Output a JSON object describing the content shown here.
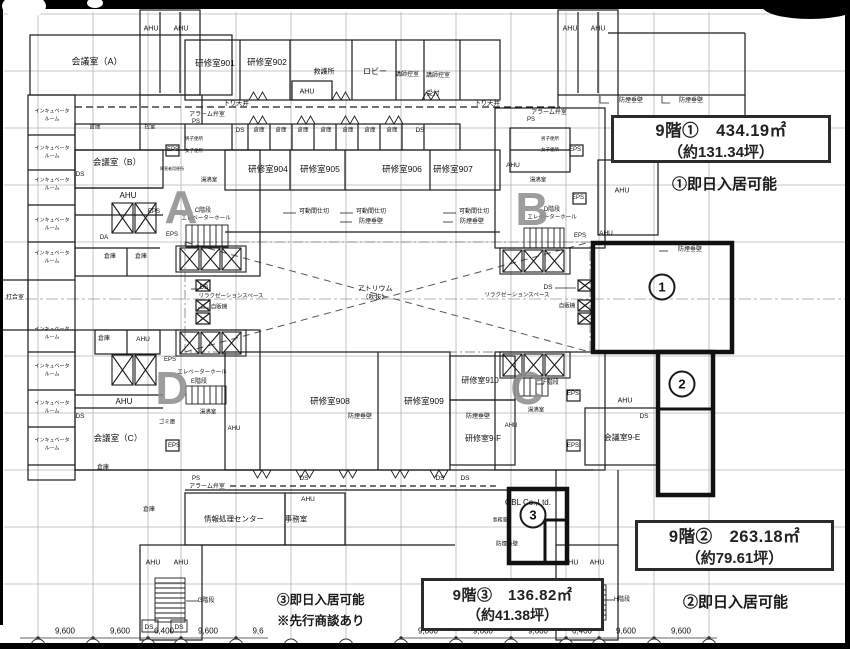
{
  "plan": {
    "boxes": {
      "area1": {
        "line1": "9階①　434.19㎡",
        "line2": "（約131.34坪）",
        "note": "①即日入居可能"
      },
      "area2": {
        "line1": "9階②　263.18㎡",
        "line2": "（約79.61坪）",
        "note": "②即日入居可能"
      },
      "area3": {
        "line1": "9階③　136.82㎡",
        "line2": "（約41.38坪）",
        "note_line1": "③即日入居可能",
        "note_line2": "※先行商談あり"
      }
    },
    "zone_letters": [
      {
        "t": "A",
        "x": 181,
        "y": 207
      },
      {
        "t": "B",
        "x": 532,
        "y": 209
      },
      {
        "t": "D",
        "x": 172,
        "y": 388
      },
      {
        "t": "C",
        "x": 527,
        "y": 388
      }
    ],
    "area_markers": [
      {
        "n": "1",
        "x": 662,
        "y": 287
      },
      {
        "n": "2",
        "x": 682,
        "y": 384
      },
      {
        "n": "3",
        "x": 533,
        "y": 515
      }
    ],
    "labels": [
      {
        "t": "AHU",
        "x": 151,
        "y": 29,
        "s": 7
      },
      {
        "t": "AHU",
        "x": 181,
        "y": 29,
        "s": 7
      },
      {
        "t": "AHU",
        "x": 570,
        "y": 29,
        "s": 7
      },
      {
        "t": "AHU",
        "x": 598,
        "y": 29,
        "s": 7
      },
      {
        "t": "会議室（A）",
        "x": 97,
        "y": 62,
        "s": 9
      },
      {
        "t": "研修室901",
        "x": 215,
        "y": 63,
        "s": 8.5
      },
      {
        "t": "研修室902",
        "x": 267,
        "y": 62,
        "s": 8.5
      },
      {
        "t": "救護所",
        "x": 324,
        "y": 72,
        "s": 7
      },
      {
        "t": "ロビー",
        "x": 375,
        "y": 72,
        "s": 8
      },
      {
        "t": "講師控室",
        "x": 407,
        "y": 75,
        "s": 6
      },
      {
        "t": "講師控室",
        "x": 438,
        "y": 76,
        "s": 6
      },
      {
        "t": "受付",
        "x": 433,
        "y": 94,
        "s": 6.5
      },
      {
        "t": "AHU",
        "x": 307,
        "y": 92,
        "s": 7
      },
      {
        "t": "下り天井",
        "x": 236,
        "y": 104,
        "s": 6.5
      },
      {
        "t": "下り天井",
        "x": 487,
        "y": 104,
        "s": 6.5
      },
      {
        "t": "DS",
        "x": 240,
        "y": 131,
        "s": 6.5
      },
      {
        "t": "倉庫",
        "x": 95,
        "y": 128,
        "s": 5.5
      },
      {
        "t": "控室",
        "x": 150,
        "y": 128,
        "s": 5.5
      },
      {
        "t": "倉庫",
        "x": 259,
        "y": 131,
        "s": 5.5
      },
      {
        "t": "倉庫",
        "x": 281,
        "y": 131,
        "s": 5.5
      },
      {
        "t": "倉庫",
        "x": 303,
        "y": 131,
        "s": 5.5
      },
      {
        "t": "倉庫",
        "x": 326,
        "y": 131,
        "s": 5.5
      },
      {
        "t": "倉庫",
        "x": 348,
        "y": 131,
        "s": 5.5
      },
      {
        "t": "倉庫",
        "x": 370,
        "y": 131,
        "s": 5.5
      },
      {
        "t": "倉庫",
        "x": 392,
        "y": 131,
        "s": 5.5
      },
      {
        "t": "DS",
        "x": 420,
        "y": 131,
        "s": 6.5
      },
      {
        "t": "アラーム弁室",
        "x": 207,
        "y": 115,
        "s": 6
      },
      {
        "t": "PS",
        "x": 196,
        "y": 122,
        "s": 6
      },
      {
        "t": "アラーム弁室",
        "x": 549,
        "y": 113,
        "s": 6
      },
      {
        "t": "PS",
        "x": 531,
        "y": 120,
        "s": 6
      },
      {
        "t": "インキュベータ",
        "x": 52,
        "y": 112,
        "s": 5
      },
      {
        "t": "ルーム",
        "x": 52,
        "y": 120,
        "s": 5
      },
      {
        "t": "インキュベータ",
        "x": 52,
        "y": 149,
        "s": 5
      },
      {
        "t": "ルーム",
        "x": 52,
        "y": 157,
        "s": 5
      },
      {
        "t": "インキュベータ",
        "x": 52,
        "y": 181,
        "s": 5
      },
      {
        "t": "ルーム",
        "x": 52,
        "y": 189,
        "s": 5
      },
      {
        "t": "インキュベータ",
        "x": 52,
        "y": 221,
        "s": 5
      },
      {
        "t": "ルーム",
        "x": 52,
        "y": 229,
        "s": 5
      },
      {
        "t": "インキュベータ",
        "x": 52,
        "y": 254,
        "s": 5
      },
      {
        "t": "ルーム",
        "x": 52,
        "y": 262,
        "s": 5
      },
      {
        "t": "インキュベータ",
        "x": 52,
        "y": 330,
        "s": 5
      },
      {
        "t": "ルーム",
        "x": 52,
        "y": 338,
        "s": 5
      },
      {
        "t": "インキュベータ",
        "x": 52,
        "y": 367,
        "s": 5
      },
      {
        "t": "ルーム",
        "x": 52,
        "y": 375,
        "s": 5
      },
      {
        "t": "インキュベータ",
        "x": 52,
        "y": 404,
        "s": 5
      },
      {
        "t": "ルーム",
        "x": 52,
        "y": 412,
        "s": 5
      },
      {
        "t": "インキュベータ",
        "x": 52,
        "y": 441,
        "s": 5
      },
      {
        "t": "ルーム",
        "x": 52,
        "y": 449,
        "s": 5
      },
      {
        "t": "打合室",
        "x": 15,
        "y": 298,
        "s": 6
      },
      {
        "t": "会議室（B）",
        "x": 117,
        "y": 162,
        "s": 8.5
      },
      {
        "t": "EPS",
        "x": 173,
        "y": 150,
        "s": 6
      },
      {
        "t": "DS",
        "x": 80,
        "y": 175,
        "s": 6.5
      },
      {
        "t": "AHU",
        "x": 128,
        "y": 196,
        "s": 8
      },
      {
        "t": "男子便所",
        "x": 194,
        "y": 139,
        "s": 4.5
      },
      {
        "t": "女子便所",
        "x": 194,
        "y": 151,
        "s": 4.5
      },
      {
        "t": "障害者用便所",
        "x": 172,
        "y": 169,
        "s": 4
      },
      {
        "t": "湯沸室",
        "x": 209,
        "y": 181,
        "s": 5.5
      },
      {
        "t": "C階段",
        "x": 203,
        "y": 211,
        "s": 6
      },
      {
        "t": "エレベーターホール",
        "x": 206,
        "y": 219,
        "s": 5.5
      },
      {
        "t": "EPS",
        "x": 154,
        "y": 212,
        "s": 6
      },
      {
        "t": "EPS",
        "x": 172,
        "y": 235,
        "s": 6
      },
      {
        "t": "DA",
        "x": 104,
        "y": 238,
        "s": 6
      },
      {
        "t": "倉庫",
        "x": 110,
        "y": 257,
        "s": 6
      },
      {
        "t": "倉庫",
        "x": 141,
        "y": 257,
        "s": 6
      },
      {
        "t": "研修室904",
        "x": 268,
        "y": 169,
        "s": 8.5
      },
      {
        "t": "研修室905",
        "x": 320,
        "y": 169,
        "s": 8.5
      },
      {
        "t": "研修室906",
        "x": 402,
        "y": 169,
        "s": 8.5
      },
      {
        "t": "研修室907",
        "x": 453,
        "y": 169,
        "s": 8.5
      },
      {
        "t": "可動間仕切",
        "x": 314,
        "y": 212,
        "s": 6
      },
      {
        "t": "可動間仕切",
        "x": 371,
        "y": 212,
        "s": 6
      },
      {
        "t": "防煙垂壁",
        "x": 371,
        "y": 222,
        "s": 6
      },
      {
        "t": "可動間仕切",
        "x": 474,
        "y": 212,
        "s": 6
      },
      {
        "t": "防煙垂壁",
        "x": 472,
        "y": 222,
        "s": 6
      },
      {
        "t": "AHU",
        "x": 513,
        "y": 166,
        "s": 6.5
      },
      {
        "t": "男子便所",
        "x": 550,
        "y": 139,
        "s": 4.5
      },
      {
        "t": "女子便所",
        "x": 550,
        "y": 150,
        "s": 4.5
      },
      {
        "t": "湯沸室",
        "x": 538,
        "y": 181,
        "s": 5.5
      },
      {
        "t": "EPS",
        "x": 575,
        "y": 150,
        "s": 6
      },
      {
        "t": "EPS",
        "x": 578,
        "y": 198,
        "s": 6
      },
      {
        "t": "EPS",
        "x": 580,
        "y": 236,
        "s": 6
      },
      {
        "t": "D階段",
        "x": 552,
        "y": 210,
        "s": 6
      },
      {
        "t": "エレベーターホール",
        "x": 552,
        "y": 218,
        "s": 5.5
      },
      {
        "t": "防煙垂壁",
        "x": 631,
        "y": 101,
        "s": 6
      },
      {
        "t": "防煙垂壁",
        "x": 691,
        "y": 101,
        "s": 6
      },
      {
        "t": "AHU",
        "x": 622,
        "y": 191,
        "s": 7
      },
      {
        "t": "防煙垂壁",
        "x": 690,
        "y": 250,
        "s": 6
      },
      {
        "t": "AHU",
        "x": 606,
        "y": 234,
        "s": 6.5
      },
      {
        "t": "アトリウム",
        "x": 375,
        "y": 289,
        "s": 7
      },
      {
        "t": "（吹抜）",
        "x": 375,
        "y": 298,
        "s": 6.5
      },
      {
        "t": "DS",
        "x": 204,
        "y": 288,
        "s": 6.5
      },
      {
        "t": "リラクゼーションスペース",
        "x": 231,
        "y": 297,
        "s": 5.5
      },
      {
        "t": "自販機",
        "x": 219,
        "y": 308,
        "s": 5.5
      },
      {
        "t": "DS",
        "x": 548,
        "y": 288,
        "s": 6.5
      },
      {
        "t": "リラクゼーションスペース",
        "x": 517,
        "y": 296,
        "s": 5.5
      },
      {
        "t": "自販機",
        "x": 567,
        "y": 307,
        "s": 5.5
      },
      {
        "t": "EPS",
        "x": 170,
        "y": 360,
        "s": 6
      },
      {
        "t": "エレベーターホール",
        "x": 202,
        "y": 373,
        "s": 5.5
      },
      {
        "t": "E階段",
        "x": 199,
        "y": 382,
        "s": 6
      },
      {
        "t": "AHU",
        "x": 143,
        "y": 340,
        "s": 6.5
      },
      {
        "t": "倉庫",
        "x": 104,
        "y": 339,
        "s": 6
      },
      {
        "t": "DS",
        "x": 80,
        "y": 417,
        "s": 6.5
      },
      {
        "t": "AHU",
        "x": 124,
        "y": 402,
        "s": 8
      },
      {
        "t": "会議室（C）",
        "x": 118,
        "y": 438,
        "s": 8.5
      },
      {
        "t": "ゴミ庫",
        "x": 167,
        "y": 423,
        "s": 5.5
      },
      {
        "t": "EPS",
        "x": 174,
        "y": 446,
        "s": 6
      },
      {
        "t": "湯沸室",
        "x": 208,
        "y": 413,
        "s": 5.5
      },
      {
        "t": "AHU",
        "x": 234,
        "y": 429,
        "s": 6
      },
      {
        "t": "倉庫",
        "x": 103,
        "y": 468,
        "s": 6
      },
      {
        "t": "アラーム弁室",
        "x": 207,
        "y": 487,
        "s": 6
      },
      {
        "t": "PS",
        "x": 196,
        "y": 479,
        "s": 6
      },
      {
        "t": "研修室908",
        "x": 330,
        "y": 401,
        "s": 8.5
      },
      {
        "t": "防煙垂壁",
        "x": 360,
        "y": 417,
        "s": 6
      },
      {
        "t": "研修室909",
        "x": 424,
        "y": 401,
        "s": 8.5
      },
      {
        "t": "防煙垂壁",
        "x": 478,
        "y": 417,
        "s": 6
      },
      {
        "t": "研修室910",
        "x": 480,
        "y": 381,
        "s": 8
      },
      {
        "t": "研修室9-F",
        "x": 483,
        "y": 439,
        "s": 8
      },
      {
        "t": "AHU",
        "x": 511,
        "y": 426,
        "s": 6
      },
      {
        "t": "F階段",
        "x": 551,
        "y": 383,
        "s": 6
      },
      {
        "t": "湯沸室",
        "x": 536,
        "y": 411,
        "s": 5.5
      },
      {
        "t": "EPS",
        "x": 573,
        "y": 394,
        "s": 6
      },
      {
        "t": "EPS",
        "x": 573,
        "y": 446,
        "s": 6
      },
      {
        "t": "AHU",
        "x": 625,
        "y": 401,
        "s": 7
      },
      {
        "t": "DS",
        "x": 644,
        "y": 417,
        "s": 6.5
      },
      {
        "t": "会議室9-E",
        "x": 622,
        "y": 438,
        "s": 8
      },
      {
        "t": "DS",
        "x": 304,
        "y": 479,
        "s": 6.5
      },
      {
        "t": "DS",
        "x": 440,
        "y": 479,
        "s": 6.5
      },
      {
        "t": "DS",
        "x": 465,
        "y": 479,
        "s": 6.5
      },
      {
        "t": "情報処理センター",
        "x": 234,
        "y": 519,
        "s": 7.5
      },
      {
        "t": "事務室",
        "x": 296,
        "y": 519,
        "s": 7.5
      },
      {
        "t": "AHU",
        "x": 308,
        "y": 500,
        "s": 6.5
      },
      {
        "t": "倉庫",
        "x": 149,
        "y": 510,
        "s": 6
      },
      {
        "t": "OBL Co.,Ltd.",
        "x": 528,
        "y": 503,
        "s": 8
      },
      {
        "t": "事務室",
        "x": 500,
        "y": 521,
        "s": 5
      },
      {
        "t": "防煙垂壁",
        "x": 507,
        "y": 545,
        "s": 5.5
      },
      {
        "t": "AHU",
        "x": 153,
        "y": 563,
        "s": 7
      },
      {
        "t": "AHU",
        "x": 181,
        "y": 563,
        "s": 7
      },
      {
        "t": "G階段",
        "x": 206,
        "y": 601,
        "s": 6
      },
      {
        "t": "DS",
        "x": 149,
        "y": 628,
        "s": 6.5
      },
      {
        "t": "DS",
        "x": 179,
        "y": 628,
        "s": 6.5
      },
      {
        "t": "AHU",
        "x": 571,
        "y": 563,
        "s": 7
      },
      {
        "t": "AHU",
        "x": 597,
        "y": 563,
        "s": 7
      },
      {
        "t": "H階段",
        "x": 622,
        "y": 600,
        "s": 6
      },
      {
        "t": "DS",
        "x": 596,
        "y": 612,
        "s": 6
      }
    ],
    "dimensions": [
      {
        "v": "9,600",
        "x": 65
      },
      {
        "v": "9,600",
        "x": 120
      },
      {
        "v": "6,400",
        "x": 164
      },
      {
        "v": "9,600",
        "x": 208
      },
      {
        "v": "9,6",
        "x": 258
      },
      {
        "v": "9,600",
        "x": 428
      },
      {
        "v": "9,600",
        "x": 483
      },
      {
        "v": "9,600",
        "x": 538
      },
      {
        "v": "6,400",
        "x": 582
      },
      {
        "v": "9,600",
        "x": 626
      },
      {
        "v": "9,600",
        "x": 681
      }
    ]
  }
}
